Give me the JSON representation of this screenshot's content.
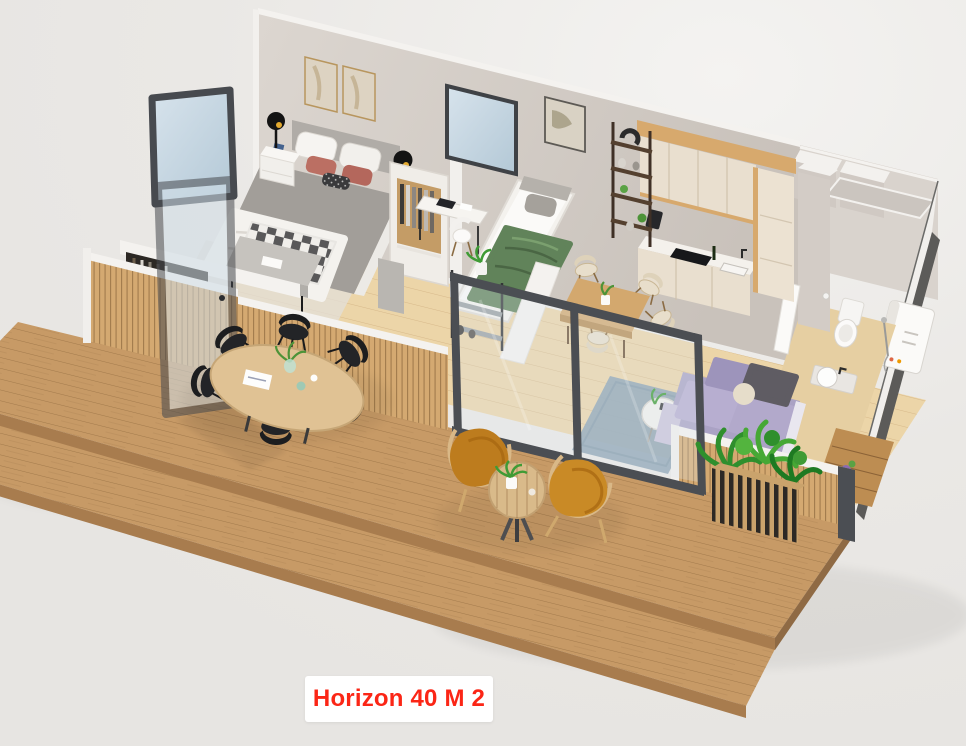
{
  "caption": {
    "text": "Horizon 40 M 2"
  },
  "palette": {
    "bg": "#e9e7e4",
    "bgLight": "#f4f3f1",
    "deck": "#c79a66",
    "deckDark": "#a87c4e",
    "deckEdge": "#8f6a44",
    "floor": "#ecd5a8",
    "wall": "#d5cfc9",
    "wallLight": "#ddd7d1",
    "white": "#f6f4f1",
    "slatWood": "#d4a971",
    "frameDark": "#4b4e53",
    "glass": "#c6d8e4",
    "accentWood": "#d7a96d",
    "cabinet": "#e9dfcf",
    "counter": "#f4f1ec",
    "sofa": "#aaa2c4",
    "sofaDark": "#5f5c63",
    "rugBlue": "#8aa0b0",
    "blanketGreen": "#61835a",
    "plantGreen": "#3f9b35",
    "amber": "#bd7c1e",
    "chairBlack": "#212225",
    "benchGray": "#c6c3be",
    "pinkPillow": "#bb6f63",
    "labelRed": "#fb2616",
    "labelBg": "#ffffff"
  }
}
